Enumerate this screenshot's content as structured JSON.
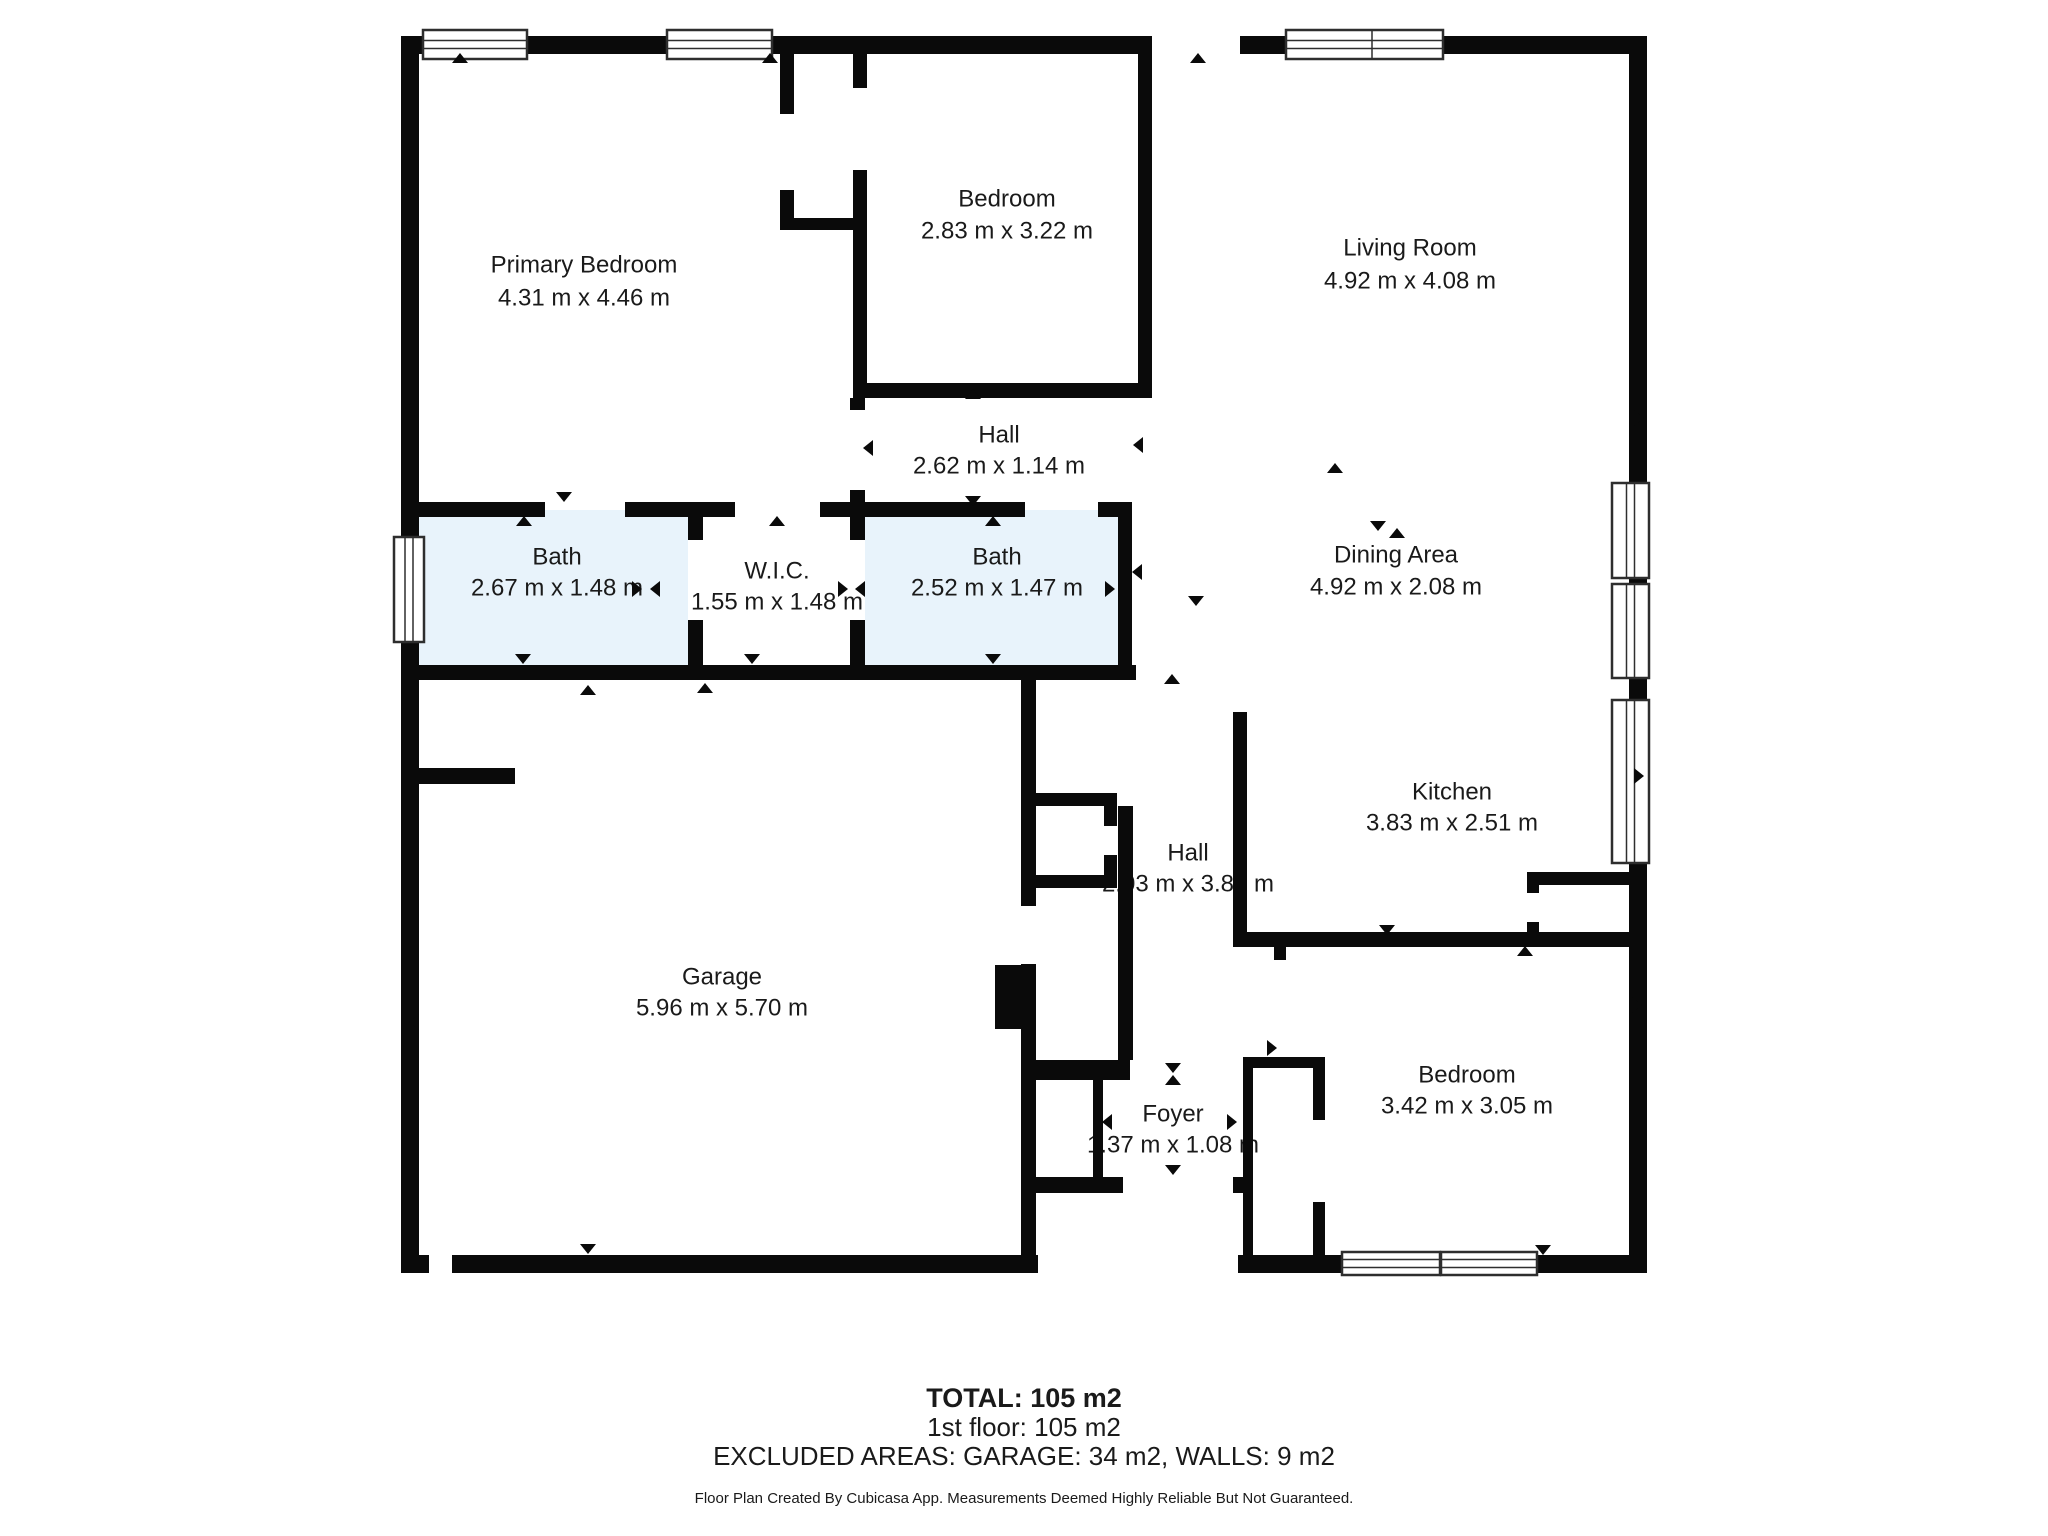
{
  "floor_plan": {
    "rooms": [
      {
        "name": "Primary Bedroom",
        "dims": "4.31 m x 4.46 m"
      },
      {
        "name": "Bedroom",
        "dims": "2.83 m x 3.22 m"
      },
      {
        "name": "Living Room",
        "dims": "4.92 m x 4.08 m"
      },
      {
        "name": "Hall",
        "dims": "2.62 m x 1.14 m"
      },
      {
        "name": "Bath",
        "dims": "2.67 m x 1.48 m"
      },
      {
        "name": "W.I.C.",
        "dims": "1.55 m x 1.48 m"
      },
      {
        "name": "Bath",
        "dims": "2.52 m x 1.47 m"
      },
      {
        "name": "Dining Area",
        "dims": "4.92 m x 2.08 m"
      },
      {
        "name": "Kitchen",
        "dims": "3.83 m x 2.51 m"
      },
      {
        "name": "Hall",
        "dims": "2.03 m x 3.88 m"
      },
      {
        "name": "Garage",
        "dims": "5.96 m x 5.70 m"
      },
      {
        "name": "Foyer",
        "dims": "1.37 m x 1.08 m"
      },
      {
        "name": "Bedroom",
        "dims": "3.42 m x 3.05 m"
      }
    ],
    "summary": {
      "total": "TOTAL: 105 m2",
      "floor": "1st floor: 105 m2",
      "excluded": "EXCLUDED AREAS: GARAGE: 34 m2, WALLS: 9 m2",
      "disclaimer": "Floor Plan Created By Cubicasa App. Measurements Deemed Highly Reliable But Not Guaranteed."
    },
    "colors": {
      "wall": "#0a0a0a",
      "bath_fill": "#e8f3fb",
      "text": "#1a1a1a"
    }
  }
}
